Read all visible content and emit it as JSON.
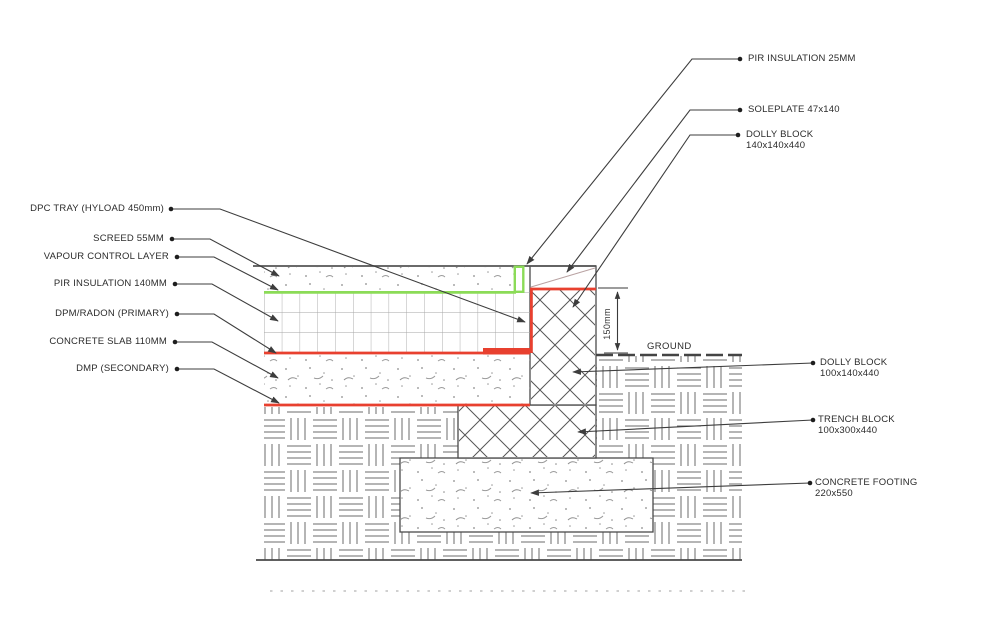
{
  "drawing": {
    "title": "floor-foundation-junction-section",
    "left_labels": [
      {
        "text": "DPC TRAY (HYLOAD 450mm)"
      },
      {
        "text": "SCREED 55MM"
      },
      {
        "text": "VAPOUR CONTROL LAYER"
      },
      {
        "text": "PIR INSULATION 140MM"
      },
      {
        "text": "DPM/RADON (PRIMARY)"
      },
      {
        "text": "CONCRETE SLAB 110MM"
      },
      {
        "text": "DMP (SECONDARY)"
      }
    ],
    "right_labels": [
      {
        "line1": "PIR INSULATION 25MM",
        "line2": ""
      },
      {
        "line1": "SOLEPLATE 47x140",
        "line2": ""
      },
      {
        "line1": "DOLLY BLOCK",
        "line2": "140x140x440"
      },
      {
        "line1": "DOLLY BLOCK",
        "line2": "100x140x440"
      },
      {
        "line1": "TRENCH BLOCK",
        "line2": "100x300x440"
      },
      {
        "line1": "CONCRETE FOOTING",
        "line2": "220x550"
      }
    ],
    "annotations": {
      "ground_label": "GROUND",
      "dimension_150": "150mm"
    },
    "colors": {
      "line": "#4a4a4a",
      "leader": "#3d3d3d",
      "red_membrane": "#e8402f",
      "green_membrane": "#8bdb57",
      "hatch": "#6b6b6b",
      "text": "#2b2b2b"
    }
  }
}
